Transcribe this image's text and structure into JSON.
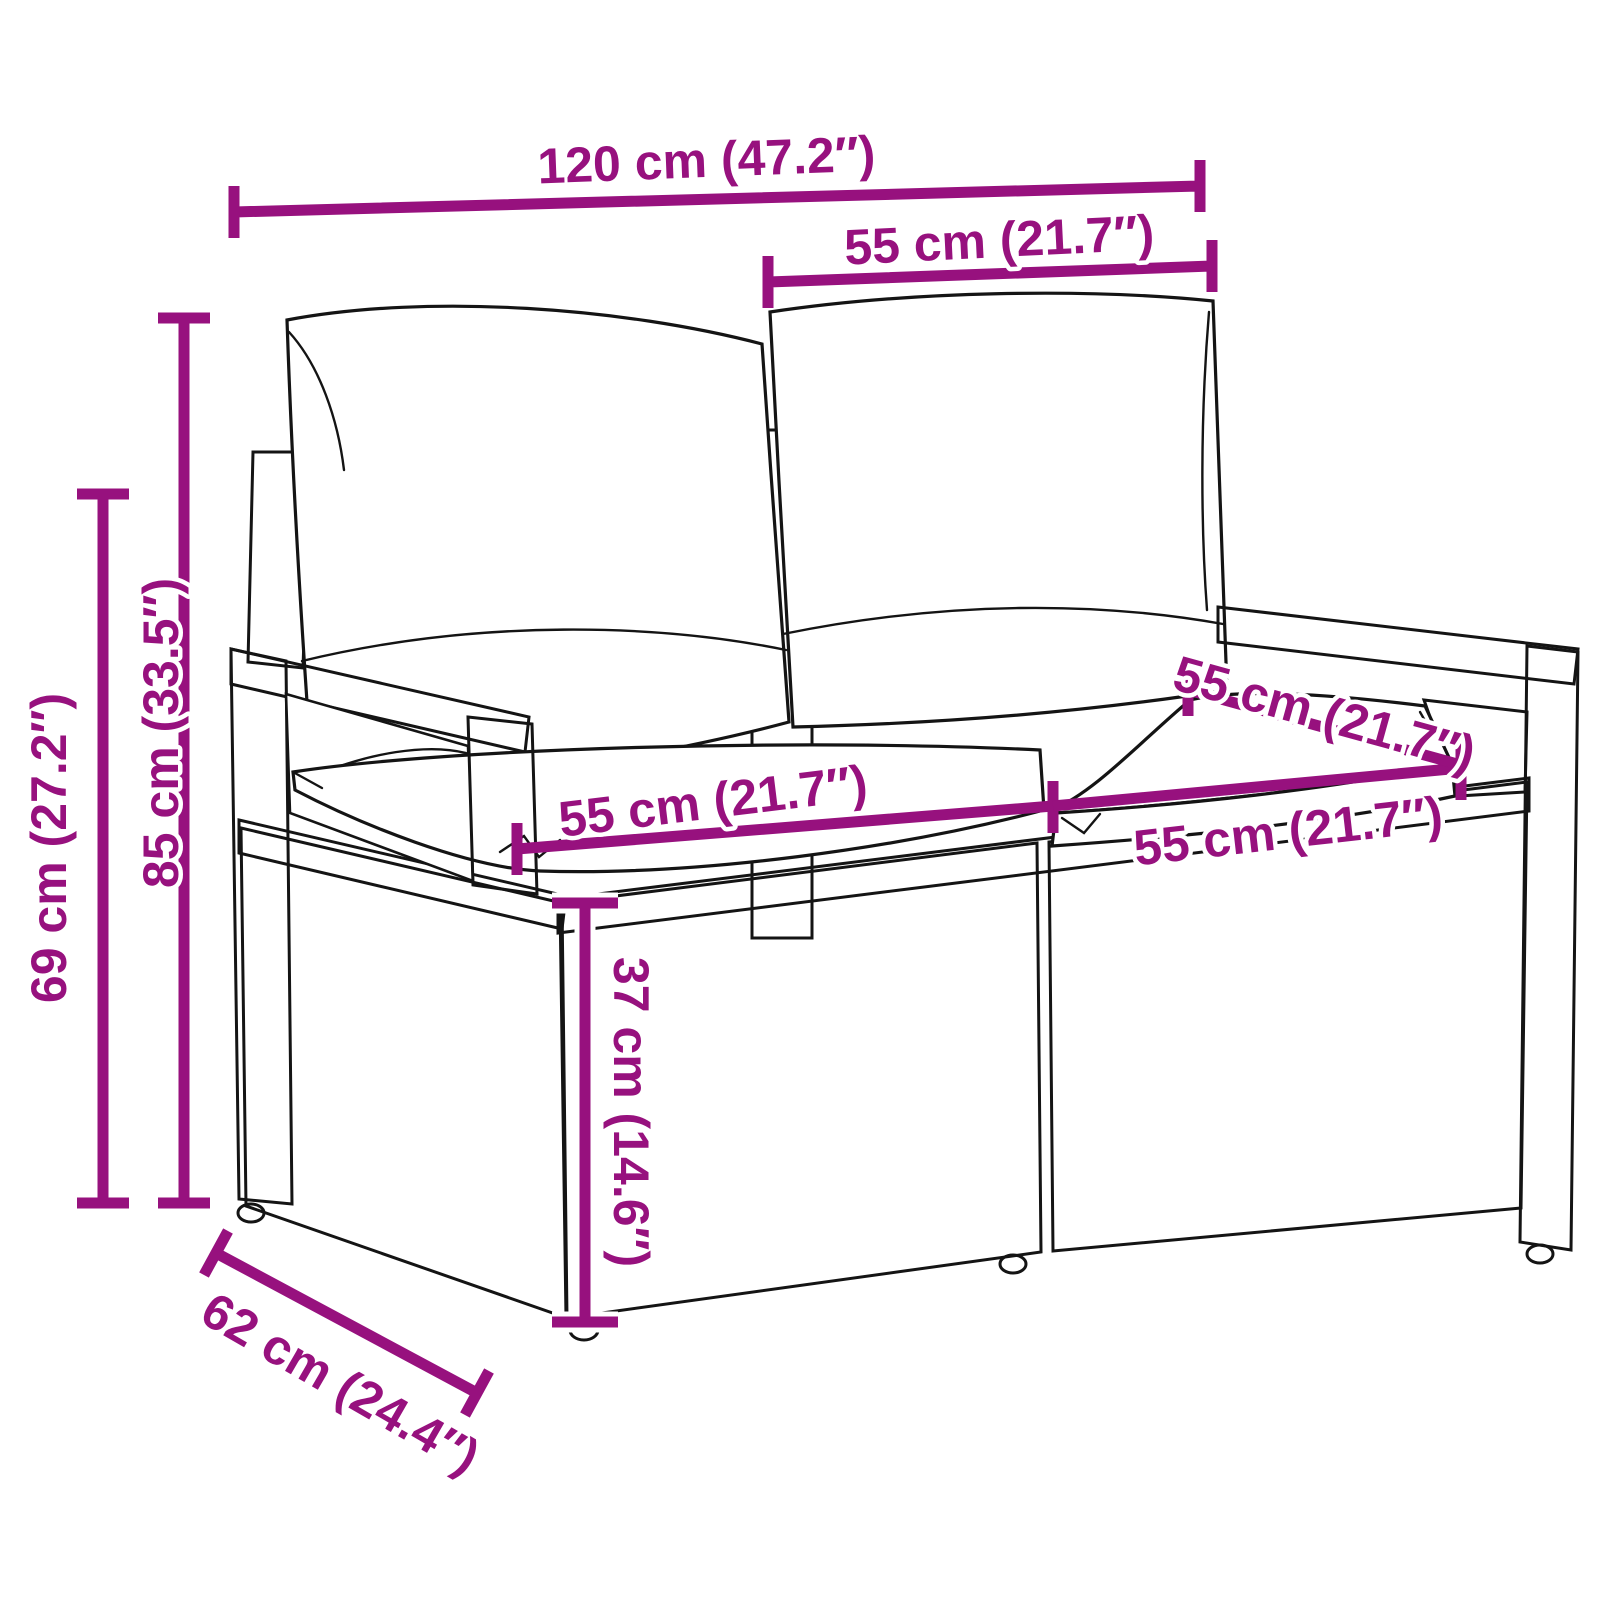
{
  "diagram": {
    "subject": "poly rattan 2-seater garden sofa with cushions",
    "accent_color": "#97117E",
    "outline_color": "#141414",
    "background_color": "#FFFFFF",
    "dims": {
      "overall_width": {
        "label": "120 cm (47.2″)",
        "value_cm": 120,
        "value_in": 47.2
      },
      "back_cushion_width": {
        "label": "55 cm (21.7″)",
        "value_cm": 55,
        "value_in": 21.7
      },
      "total_height": {
        "label": "85 cm (33.5″)",
        "value_cm": 85,
        "value_in": 33.5
      },
      "armrest_height": {
        "label": "69 cm (27.2″)",
        "value_cm": 69,
        "value_in": 27.2
      },
      "seat_width_left": {
        "label": "55 cm (21.7″)",
        "value_cm": 55,
        "value_in": 21.7
      },
      "seat_width_right": {
        "label": "55 cm (21.7″)",
        "value_cm": 55,
        "value_in": 21.7
      },
      "seat_depth": {
        "label": "55 cm (21.7″)",
        "value_cm": 55,
        "value_in": 21.7
      },
      "seat_height": {
        "label": "37 cm (14.6″)",
        "value_cm": 37,
        "value_in": 14.6
      },
      "base_depth": {
        "label": "62 cm (24.4″)",
        "value_cm": 62,
        "value_in": 24.4
      }
    }
  }
}
